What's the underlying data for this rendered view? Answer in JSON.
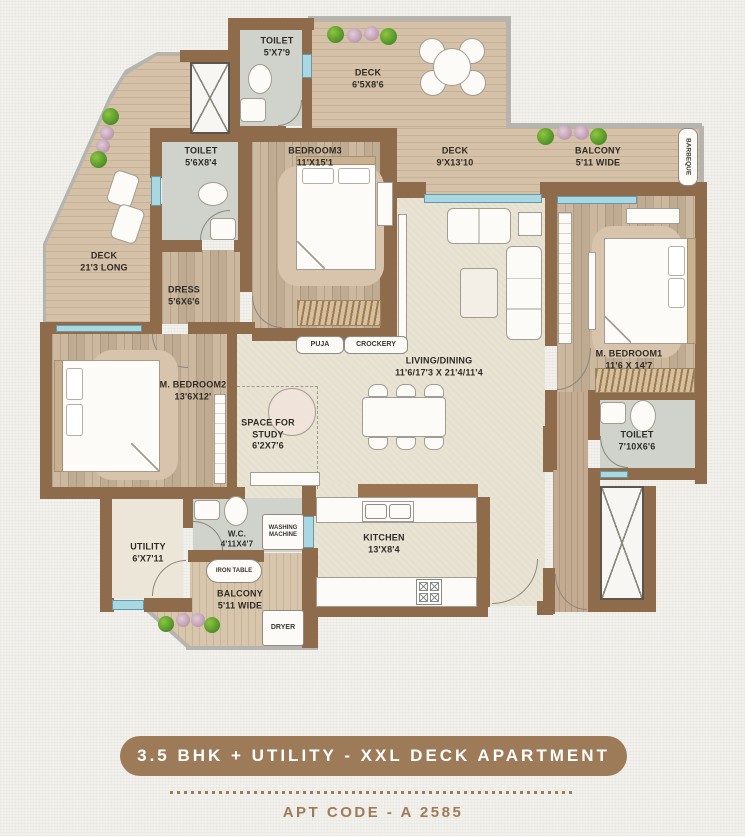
{
  "rooms": {
    "toilet_top": {
      "name": "TOILET",
      "dims": "5'X7'9"
    },
    "deck_top": {
      "name": "DECK",
      "dims": "6'5X8'6"
    },
    "deck_mid": {
      "name": "DECK",
      "dims": "9'X13'10"
    },
    "balcony_top": {
      "name": "BALCONY",
      "dims": "5'11 WIDE"
    },
    "toilet_2": {
      "name": "TOILET",
      "dims": "5'6X8'4"
    },
    "bedroom_3": {
      "name": "BEDROOM3",
      "dims": "11'X15'1"
    },
    "deck_left": {
      "name": "DECK",
      "dims": "21'3 LONG"
    },
    "dress": {
      "name": "DRESS",
      "dims": "5'6X6'6"
    },
    "m_bedroom_2": {
      "name": "M. BEDROOM2",
      "dims": "13'6X12'"
    },
    "study": {
      "name": "SPACE FOR STUDY",
      "dims": "6'2X7'6"
    },
    "living": {
      "name": "LIVING/DINING",
      "dims": "11'6/17'3 X 21'4/11'4"
    },
    "m_bedroom_1": {
      "name": "M. BEDROOM1",
      "dims": "11'6 X 14'7"
    },
    "toilet_right": {
      "name": "TOILET",
      "dims": "7'10X6'6"
    },
    "kitchen": {
      "name": "KITCHEN",
      "dims": "13'X8'4"
    },
    "utility": {
      "name": "UTILITY",
      "dims": "6'X7'11"
    },
    "wc": {
      "name": "W.C.",
      "dims": "4'11X4'7"
    },
    "balcony_bottom": {
      "name": "BALCONY",
      "dims": "5'11 WIDE"
    }
  },
  "features": {
    "barbeque": "BARBEQUE",
    "puja": "PUJA",
    "crockery": "CROCKERY",
    "washing_machine": "WASHING MACHINE",
    "iron_table": "IRON TABLE",
    "dryer": "DRYER"
  },
  "footer": {
    "banner": "3.5 BHK + UTILITY - XXL DECK APARTMENT",
    "apt_code": "APT CODE - A 2585"
  },
  "colors": {
    "wall": "#8d6b4b",
    "accent_brown": "#9d7b58",
    "window": "#a9d8e2",
    "deck_floor": "#d4c1a7",
    "room_floor": "#c9b39a",
    "living_floor": "#e9e3d3",
    "toilet_floor": "#cfd3cb"
  }
}
